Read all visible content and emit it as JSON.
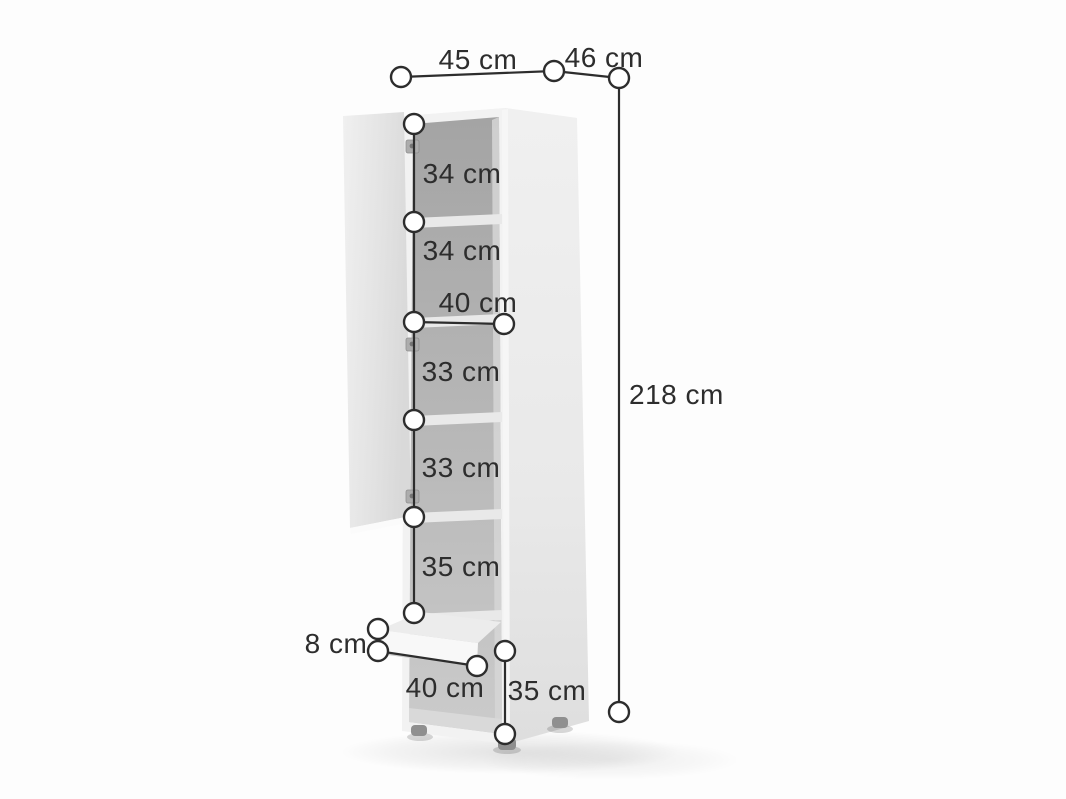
{
  "diagram": {
    "type": "furniture-dimension-diagram",
    "subject": "tall cabinet with open door, five shelf sections, drawer and open bottom compartment",
    "unit": "cm",
    "colors": {
      "dimension_line": "#2d2d2d",
      "label_text": "#2d2d2d",
      "endpoint_fill": "#ffffff",
      "cabinet_body": "#f1f1f1",
      "cabinet_side": "#e7e7e7",
      "cabinet_interior": "#b2b2b2",
      "door": "#e5e5e5",
      "background": "#fdfdfd"
    },
    "dims": {
      "top_width": "45 cm",
      "top_depth": "46 cm",
      "total_height": "218 cm",
      "sections": [
        "34 cm",
        "34 cm",
        "33 cm",
        "33 cm",
        "35 cm"
      ],
      "interior_width": "40 cm",
      "drawer_front_height": "8 cm",
      "bottom_width": "40 cm",
      "bottom_height": "35 cm"
    }
  }
}
